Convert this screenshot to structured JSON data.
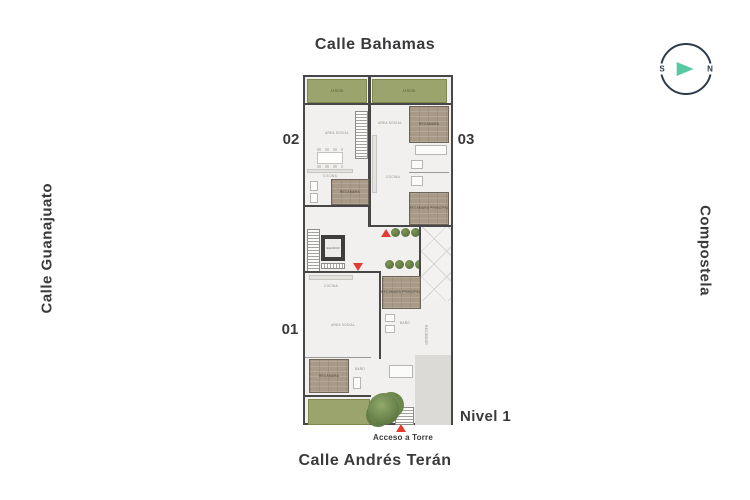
{
  "streets": {
    "top": "Calle Bahamas",
    "left": "Calle Guanajuato",
    "right": "Compostela",
    "bottom": "Calle Andrés Terán"
  },
  "compass": {
    "south": "S",
    "north": "N"
  },
  "units": {
    "u01": "01",
    "u02": "02",
    "u03": "03"
  },
  "level": {
    "label": "Nivel 1"
  },
  "access": {
    "label": "Acceso a Torre"
  },
  "rooms": {
    "area_social": "AREA SOCIAL",
    "cocina": "COCINA",
    "recamara": "RECAMARA",
    "recamara_principal": "RECAMARA PRINCIPAL",
    "bano": "BAÑO",
    "elevador": "ELEVADOR",
    "jardin": "JARDÍN",
    "recibidor": "RECIBIDOR"
  },
  "colors": {
    "accent_red": "#e23b2f",
    "compass_teal": "#57c8a2",
    "garden_green": "#9ba46d",
    "wood_tan": "#a89a87",
    "wall_dark": "#474747",
    "text_dark": "#3a3a3c"
  }
}
